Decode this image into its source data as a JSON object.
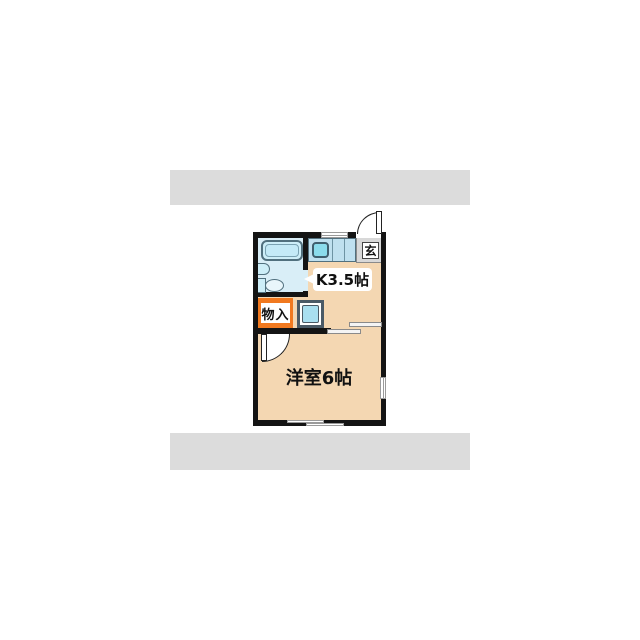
{
  "floorplan": {
    "type": "japanese-apartment-1K",
    "rooms": {
      "kitchen": {
        "label": "K3.5帖"
      },
      "western_room": {
        "label": "洋室6帖"
      },
      "entrance": {
        "label": "玄"
      },
      "closet": {
        "label": "物入"
      }
    },
    "fixtures": [
      "bathtub-icon",
      "washbasin-icon",
      "toilet-icon",
      "kitchen-sink-icon",
      "washer-pan-icon",
      "entrance-door-swing-icon",
      "room-door-swing-icon",
      "sliding-door-icon",
      "window-icon"
    ]
  },
  "colors": {
    "wall": "#141414",
    "floor": "#f4d7b2",
    "bath_floor": "#d9eef7",
    "fixture_fill": "#cdeef8",
    "counter": "#bfe0ef",
    "sink": "#8bdcec",
    "washer": "#a9dff0",
    "closet_orange": "#f1791f",
    "entrance_tile": "#d8d8d8",
    "band_gray": "#dcdcdc"
  }
}
